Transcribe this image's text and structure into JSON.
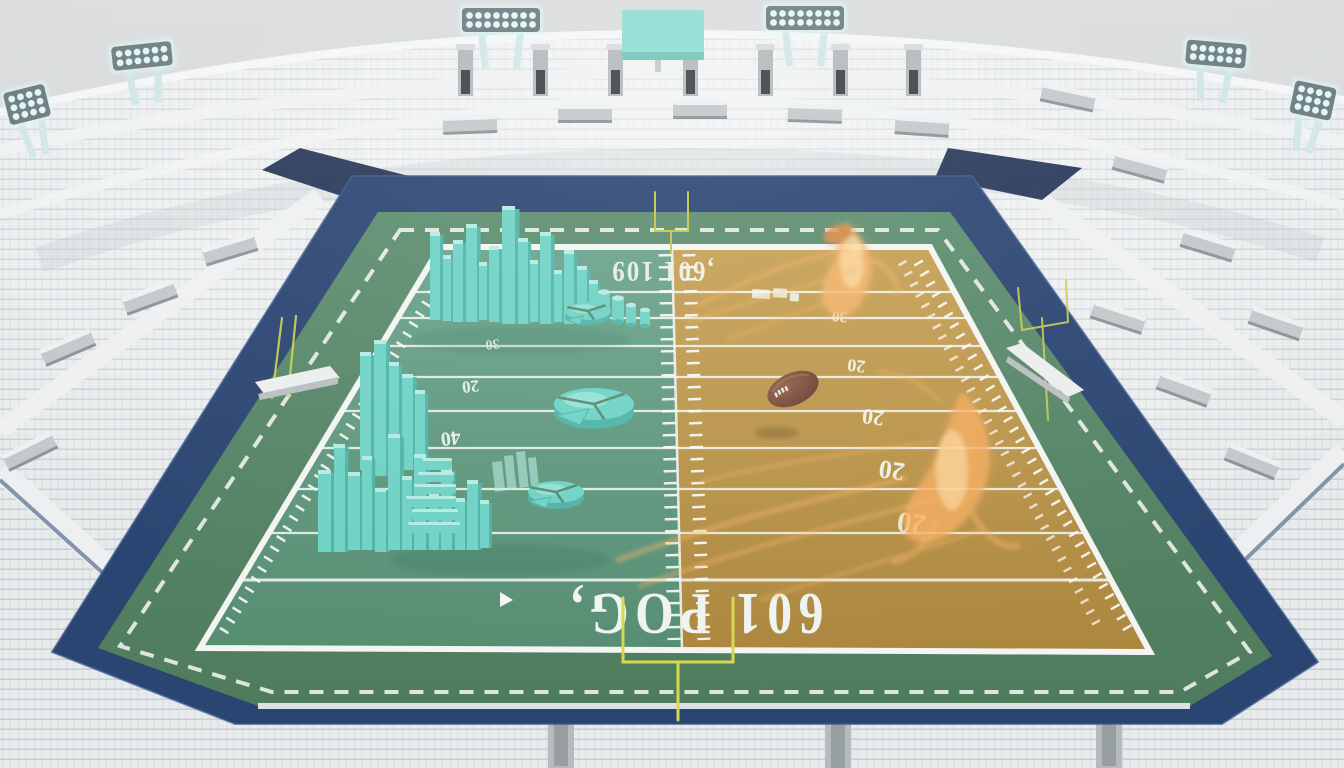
{
  "scene": {
    "description": "3D rendered empty football stadium; split-color field (teal left, gold right) with teal 3D bar-chart and pie-chart sculptures on the left half, glowing orange ghost football players and a floating football on the right half",
    "colors": {
      "sky": "#d6d8d9",
      "stand_base": "#e8ebec",
      "stand_row": "#c9ced0",
      "stand_rib": "#dde1e3",
      "rim": "#f4f6f7",
      "navy": "#2b4572",
      "navy_dark": "#17294d",
      "apron_top": "#5d8d6f",
      "apron_bottom": "#4f7c5d",
      "teal_top": "#6aa28a",
      "teal_bottom": "#578e73",
      "gold_top": "#c6a054",
      "gold_bottom": "#ac873f",
      "line_white": "#f2f5f2",
      "bar_main": "#6fd2c5",
      "bar_light": "#b4ebe3",
      "bar_dark": "#4fb4a7",
      "ghost": "#f6b469",
      "ghost_bright": "#ffdca6",
      "ball": "#7f5240",
      "ball_dark": "#5d392c",
      "goalpost": "#d6d94f",
      "scoreboard": "#8edcd2",
      "light_glow": "#d9f9f7",
      "light_frame": "#707a7e",
      "bench": "#eceeee",
      "box_gray": "#c3c8ca"
    },
    "field": {
      "endzone_near_text": "601 POG,",
      "endzone_far_text": ",601 109",
      "yard_line_ys": [
        292,
        318,
        346,
        377,
        411,
        448,
        489,
        533,
        580
      ],
      "yard_numbers_gold": [
        {
          "v": "30",
          "x": 840,
          "y": 312,
          "s": 15,
          "r": 186
        },
        {
          "v": "20",
          "x": 857,
          "y": 360,
          "s": 18,
          "r": 186
        },
        {
          "v": "20",
          "x": 874,
          "y": 410,
          "s": 22,
          "r": 187
        },
        {
          "v": "20",
          "x": 893,
          "y": 462,
          "s": 26,
          "r": 188
        },
        {
          "v": "20",
          "x": 913,
          "y": 514,
          "s": 29,
          "r": 188
        }
      ],
      "yard_numbers_teal": [
        {
          "v": "30",
          "x": 492,
          "y": 340,
          "s": 14,
          "r": 174
        },
        {
          "v": "20",
          "x": 470,
          "y": 381,
          "s": 17,
          "r": 174
        },
        {
          "v": "40",
          "x": 450,
          "y": 432,
          "s": 20,
          "r": 173
        }
      ]
    },
    "sculptures": {
      "bars_upper": [
        [
          430,
          232,
          10,
          88
        ],
        [
          443,
          255,
          8,
          66
        ],
        [
          453,
          240,
          10,
          82
        ],
        [
          466,
          224,
          11,
          98
        ],
        [
          479,
          262,
          8,
          58
        ],
        [
          489,
          246,
          10,
          76
        ],
        [
          502,
          206,
          13,
          118
        ],
        [
          518,
          238,
          10,
          86
        ],
        [
          530,
          260,
          8,
          62
        ],
        [
          540,
          232,
          11,
          92
        ],
        [
          554,
          270,
          8,
          52
        ],
        [
          564,
          250,
          10,
          74
        ],
        [
          577,
          266,
          10,
          56
        ],
        [
          589,
          280,
          9,
          42
        ]
      ],
      "cylinders_upper": [
        [
          604,
          292,
          6,
          26
        ],
        [
          618,
          298,
          6,
          24
        ],
        [
          631,
          305,
          5,
          20
        ],
        [
          645,
          310,
          5,
          16
        ]
      ],
      "bars_mid": [
        [
          360,
          352,
          11,
          118
        ],
        [
          374,
          340,
          12,
          136
        ],
        [
          389,
          362,
          10,
          108
        ],
        [
          402,
          374,
          11,
          96
        ],
        [
          415,
          390,
          10,
          80
        ]
      ],
      "bars_lower": [
        [
          318,
          470,
          13,
          82
        ],
        [
          334,
          444,
          11,
          108
        ],
        [
          348,
          472,
          12,
          78
        ],
        [
          362,
          456,
          10,
          94
        ],
        [
          375,
          488,
          11,
          64
        ],
        [
          388,
          434,
          12,
          116
        ],
        [
          402,
          476,
          10,
          74
        ],
        [
          414,
          454,
          12,
          96
        ],
        [
          429,
          492,
          10,
          58
        ],
        [
          441,
          468,
          11,
          82
        ],
        [
          455,
          498,
          10,
          52
        ],
        [
          467,
          480,
          11,
          70
        ],
        [
          480,
          500,
          9,
          48
        ]
      ],
      "stack": [
        [
          408,
          522,
          52,
          11
        ],
        [
          412,
          509,
          46,
          11
        ],
        [
          406,
          496,
          50,
          11
        ],
        [
          414,
          484,
          42,
          10
        ],
        [
          418,
          472,
          36,
          10
        ],
        [
          422,
          458,
          30,
          12
        ]
      ],
      "glass": [
        [
          492,
          462,
          10,
          30
        ],
        [
          504,
          456,
          9,
          34
        ],
        [
          516,
          452,
          9,
          36
        ],
        [
          528,
          458,
          8,
          30
        ]
      ],
      "pies": [
        [
          588,
          311,
          23,
          9
        ],
        [
          594,
          404,
          40,
          16
        ],
        [
          556,
          492,
          28,
          11
        ]
      ]
    },
    "lights": [
      [
        462,
        8,
        8,
        2,
        0
      ],
      [
        766,
        6,
        8,
        2,
        0
      ],
      [
        112,
        44,
        6,
        2,
        -6
      ],
      [
        1186,
        42,
        6,
        2,
        5
      ],
      [
        6,
        88,
        4,
        3,
        -14
      ],
      [
        1292,
        84,
        4,
        3,
        12
      ]
    ],
    "pylons": [
      458,
      533,
      608,
      683,
      758,
      833,
      906
    ],
    "gray_boxes": [
      [
        470,
        125,
        -2
      ],
      [
        585,
        114,
        0
      ],
      [
        700,
        110,
        0
      ],
      [
        815,
        114,
        2
      ],
      [
        922,
        127,
        4
      ],
      [
        230,
        250,
        -17
      ],
      [
        150,
        298,
        -20
      ],
      [
        68,
        348,
        -23
      ],
      [
        30,
        452,
        -26
      ],
      [
        1068,
        98,
        12
      ],
      [
        1140,
        168,
        15
      ],
      [
        1208,
        246,
        17
      ],
      [
        1276,
        324,
        19
      ],
      [
        1118,
        318,
        18
      ],
      [
        1184,
        390,
        20
      ],
      [
        1252,
        462,
        22
      ]
    ],
    "stair_columns": [
      [
        548,
        700
      ],
      [
        825,
        704
      ],
      [
        1096,
        700
      ]
    ]
  }
}
